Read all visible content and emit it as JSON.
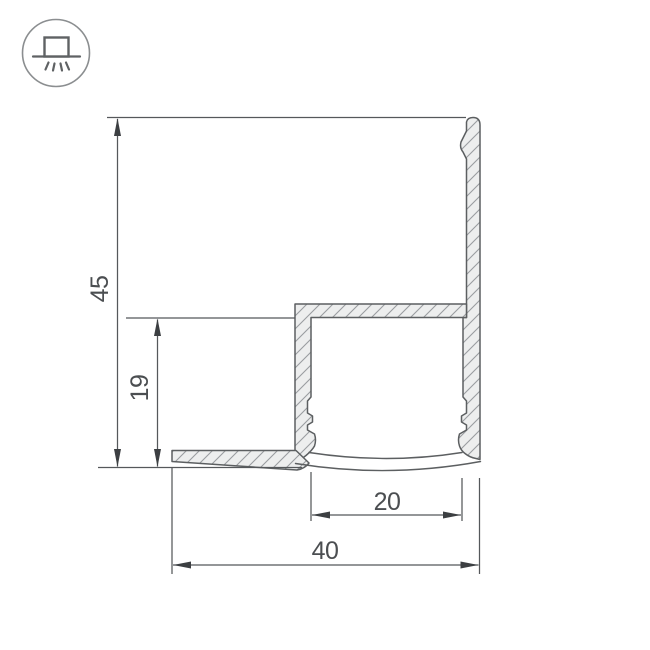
{
  "icon": {
    "name": "surface-mounted-light-icon"
  },
  "drawing": {
    "type": "led-profile-cross-section",
    "dimensions": {
      "total_height": "45",
      "inner_height": "19",
      "inner_width": "20",
      "total_width": "40"
    },
    "colors": {
      "background": "#ffffff",
      "outline": "#5c5f61",
      "fill": "#edeeee",
      "hatch": "#9a9da0",
      "dim_line": "#55585b",
      "arrow": "#3c3f42",
      "label": "#4b4e51",
      "icon_stroke": "#8b8e90",
      "icon_glyph": "#5f6264"
    }
  }
}
